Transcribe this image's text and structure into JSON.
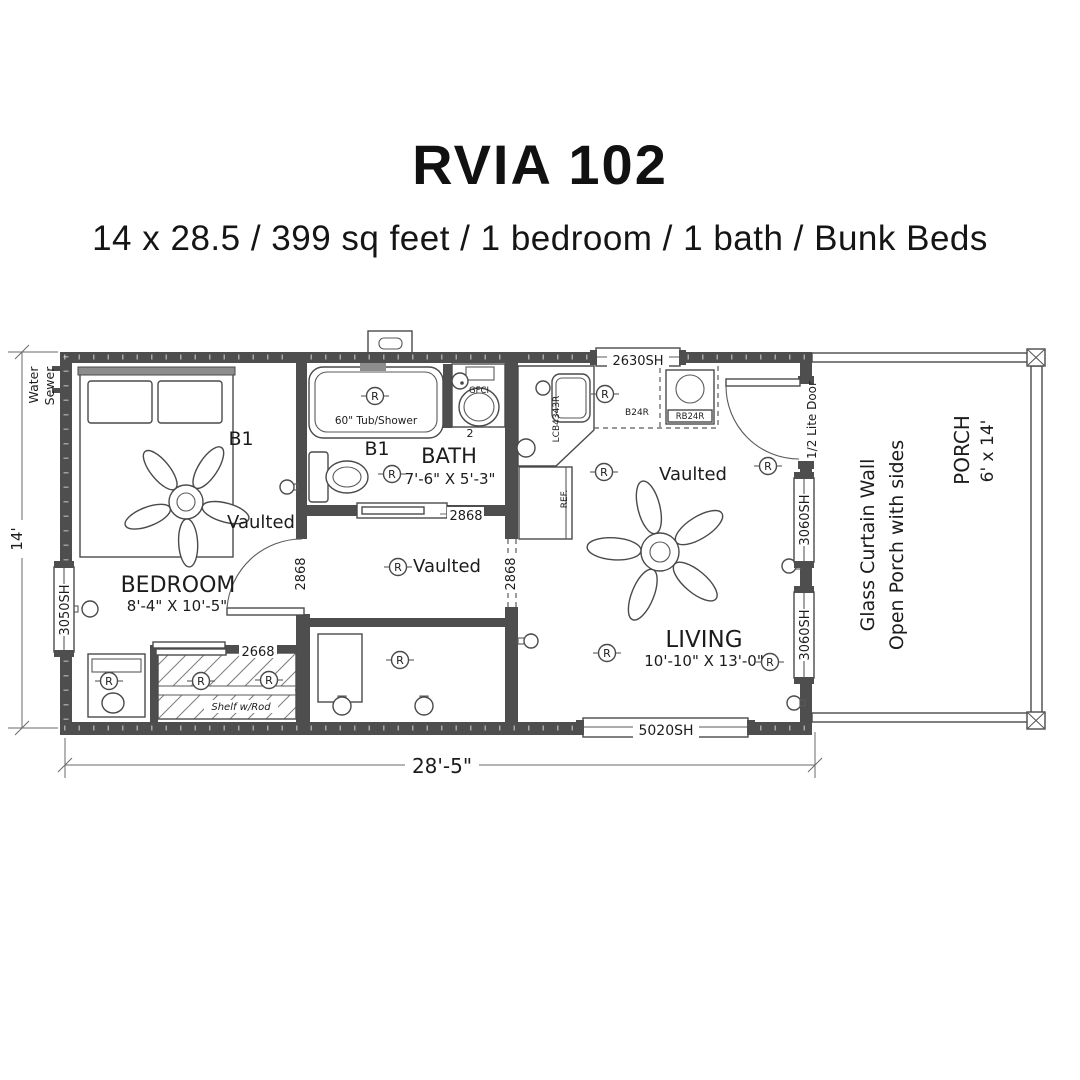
{
  "header": {
    "title": "RVIA 102",
    "subtitle": "14 x 28.5 / 399 sq feet / 1 bedroom / 1 bath / Bunk Beds"
  },
  "plan": {
    "overall_width": "28'-5\"",
    "overall_height": "14'",
    "utilities": {
      "water": "Water",
      "sewer": "Sewer"
    },
    "receptacle": "R",
    "bedroom": {
      "name": "BEDROOM",
      "size": "8'-4\" X 10'-5\"",
      "ceiling": "Vaulted",
      "marker": "B1",
      "door": "2868",
      "closet_door": "2668",
      "shelf": "Shelf w/Rod",
      "window": "3050SH"
    },
    "bath": {
      "name": "BATH",
      "size": "7'-6\" X 5'-3\"",
      "marker": "B1",
      "tub": "60\" Tub/Shower",
      "gfci": "GFCI",
      "door": "2868",
      "vanity_dim": "2"
    },
    "hall": {
      "ceiling": "Vaulted",
      "opening": "2868"
    },
    "kitchen": {
      "window": "2630SH",
      "corner_cabinet": "LCB4343R",
      "base_cabinet": "B24R",
      "range_cabinet": "RB24R",
      "fridge": "REF."
    },
    "living": {
      "name": "LIVING",
      "size": "10'-10\" X 13'-0\"",
      "ceiling": "Vaulted",
      "window_front": "5020SH",
      "window_side_upper": "3060SH",
      "window_side_lower": "3060SH",
      "entry_door": "1/2 Lite Door"
    },
    "porch": {
      "name": "PORCH",
      "size": "6' x 14'",
      "note1": "Glass Curtain Wall",
      "note2": "Open Porch with sides"
    }
  }
}
